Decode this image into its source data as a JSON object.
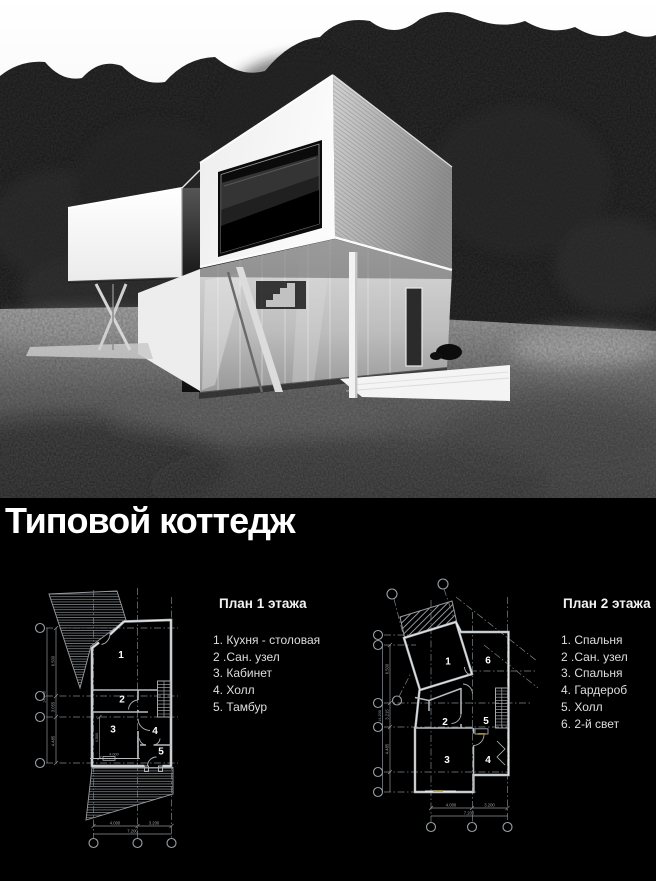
{
  "colors": {
    "background": "#000000",
    "title_text": "#ffffff",
    "plan_lines": "#c7cbd0",
    "legend_text": "#dedede"
  },
  "title": "Типовой коттедж",
  "plan1": {
    "heading": "План 1 этажа",
    "legend": [
      "1. Кухня - столовая",
      "2 .Сан. узел",
      "3. Кабинет",
      "4. Холл",
      "5. Тамбур"
    ],
    "rooms": [
      "1",
      "2",
      "3",
      "4",
      "5"
    ],
    "dims": {
      "left": [
        "6.500",
        "3.055",
        "4.485"
      ],
      "left_total": "14.040",
      "inner_v": "4.500",
      "inner_h": "4.000",
      "bottom": [
        "4.000",
        "3.200"
      ],
      "bottom_total": "7.200"
    }
  },
  "plan2": {
    "heading": "План 2 этажа",
    "legend": [
      "1. Спальня",
      "2 .Сан. узел",
      "3. Спальня",
      "4. Гардероб",
      "5. Холл",
      "6. 2-й свет"
    ],
    "rooms": [
      "1",
      "2",
      "3",
      "4",
      "5",
      "6"
    ],
    "dims": {
      "left": [
        "6.500",
        "3.215",
        "4.485"
      ],
      "left_total": "14.200",
      "bottom": [
        "4.000",
        "3.200"
      ],
      "bottom_total": "7.200"
    }
  }
}
